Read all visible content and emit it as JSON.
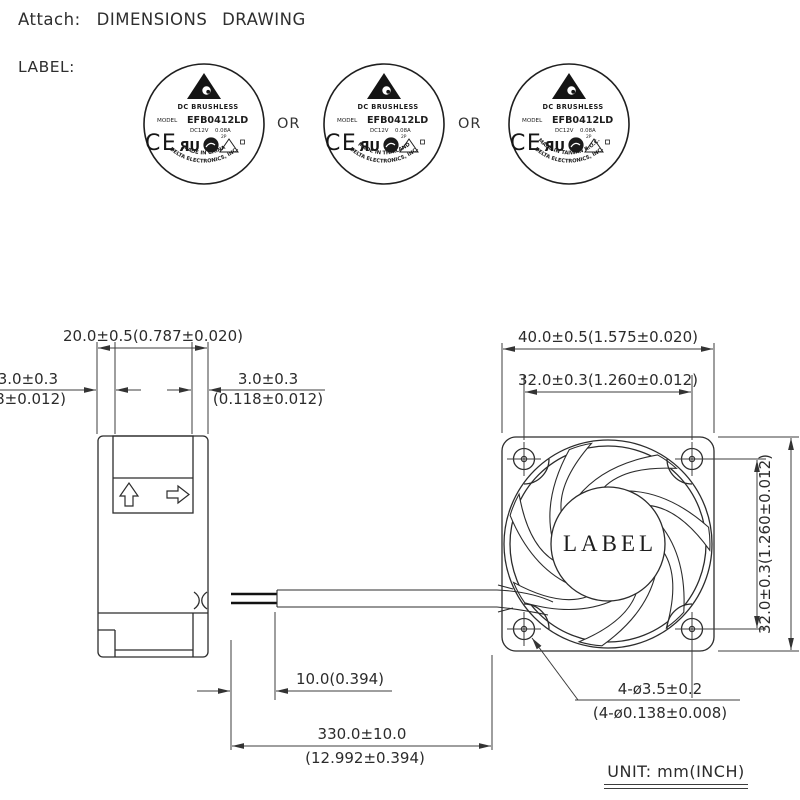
{
  "header": {
    "attach_label": "Attach:",
    "title": "DIMENSIONS DRAWING"
  },
  "label_section": {
    "caption": "LABEL:",
    "or_separator": "OR",
    "labels": [
      {
        "type_line": "DC BRUSHLESS",
        "model_label": "MODEL",
        "model": "EFB0412LD",
        "voltage": "DC12V",
        "current": "0.08A",
        "ce_mark": "CE",
        "ul_mark": "UR",
        "pin_note": "2P",
        "maker": "DELTA ELECTRONICS, INC.",
        "origin": "MADE IN CHINA"
      },
      {
        "type_line": "DC BRUSHLESS",
        "model_label": "MODEL",
        "model": "EFB0412LD",
        "voltage": "DC12V",
        "current": "0.08A",
        "ce_mark": "CE",
        "ul_mark": "UR",
        "pin_note": "2P",
        "maker": "DELTA ELECTRONICS, INC.",
        "origin": "MADE IN THAILAND"
      },
      {
        "type_line": "DC BRUSHLESS",
        "model_label": "MODEL",
        "model": "EFB0412LD",
        "voltage": "DC12V",
        "current": "0.08A",
        "ce_mark": "CE",
        "ul_mark": "UR",
        "pin_note": "2P",
        "maker": "DELTA ELECTRONICS, INC.",
        "origin": "MADE IN TAIWAN R.O.C."
      }
    ]
  },
  "drawing": {
    "dim_depth": "20.0±0.5(0.787±0.020)",
    "dim_flange_left_mm": "3.0±0.3",
    "dim_flange_left_in": "(0.118±0.012)",
    "dim_flange_right_mm": "3.0±0.3",
    "dim_flange_right_in": "(0.118±0.012)",
    "dim_width": "40.0±0.5(1.575±0.020)",
    "dim_hole_pitch_h": "32.0±0.3(1.260±0.012)",
    "dim_hole_pitch_v": "32.0±0.3(1.260±0.012)",
    "dim_strip": "10.0(0.394)",
    "dim_lead_mm": "330.0±10.0",
    "dim_lead_in": "(12.992±0.394)",
    "dim_holes_mm": "4-ø3.5±0.2",
    "dim_holes_in": "(4-ø0.138±0.008)",
    "hub_label": "LABEL",
    "unit_note": "UNIT: mm(INCH)"
  }
}
